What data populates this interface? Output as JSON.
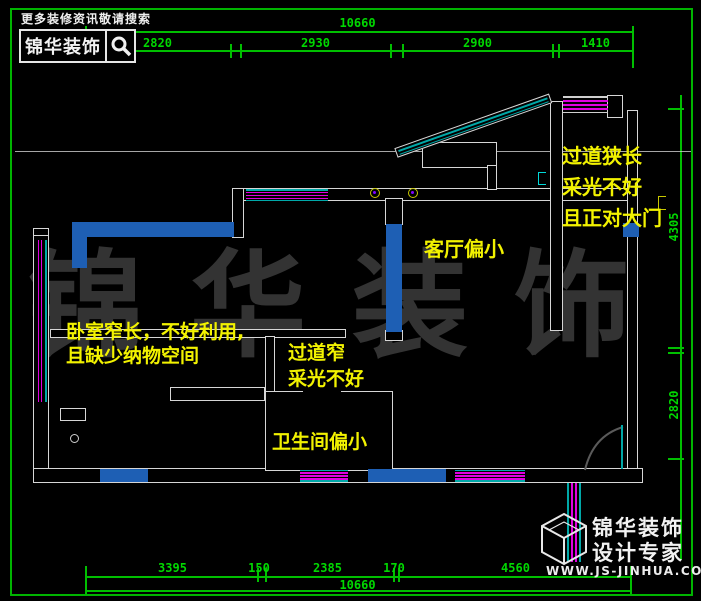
{
  "header": {
    "promo_text": "更多装修资讯敬请搜索",
    "brand_name": "锦华装饰",
    "search_icon": "magnifier-icon"
  },
  "watermark_text": "锦华装饰",
  "annotations": {
    "entry_hall": [
      "过道狭长",
      "采光不好",
      "且正对大门"
    ],
    "living_room": "客厅偏小",
    "bedroom": [
      "卧室窄长，不好利用,",
      "且缺少纳物空间"
    ],
    "corridor": [
      "过道窄",
      "采光不好"
    ],
    "bathroom": "卫生间偏小"
  },
  "dimensions": {
    "top_total": "10660",
    "top_segments": [
      "2820",
      "2930",
      "2900",
      "1410"
    ],
    "right_segments": [
      "4305",
      "2820"
    ],
    "bottom_segments": [
      "3395",
      "150",
      "2385",
      "170",
      "4560"
    ],
    "bottom_total": "10660"
  },
  "footer": {
    "brand_line1": "锦华装饰",
    "brand_line2": "设计专家",
    "url": "WWW.JS-JINHUA.COM",
    "logo_icon": "cube-logo-icon"
  },
  "colors": {
    "background": "#000000",
    "dimension_green": "#00bf00",
    "wall_white": "#d6d6d6",
    "wall_blue": "#1e5fb4",
    "window_magenta": "#e000e0",
    "window_cyan": "#00a8a8",
    "annotation_yellow": "#f2f200",
    "watermark_gray": "#333333"
  }
}
